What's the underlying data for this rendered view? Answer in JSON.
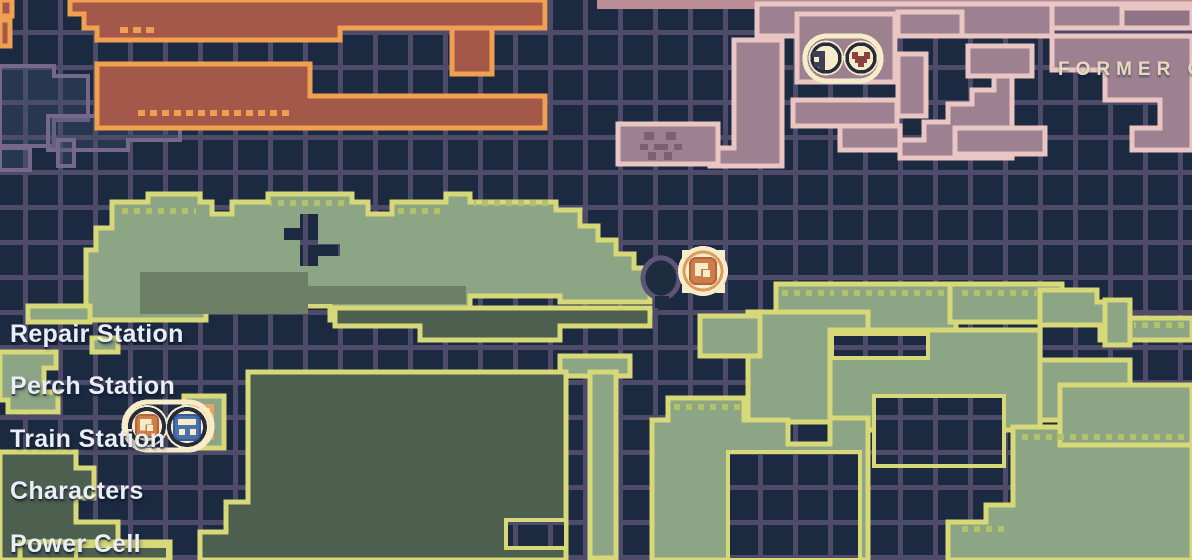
{
  "map": {
    "area_label": "FORMER CO",
    "legend": {
      "items": [
        "Repair Station",
        "Perch Station",
        "Train Station",
        "Characters",
        "Power Cell"
      ]
    },
    "markers": [
      {
        "name": "repair-perch-pair",
        "icons": [
          "wrench-icon",
          "heart-icon"
        ]
      },
      {
        "name": "character-marker",
        "icons": [
          "character-icon"
        ]
      },
      {
        "name": "train-station-pair",
        "icons": [
          "character-icon",
          "train-icon"
        ]
      }
    ],
    "palette": {
      "background": "#1b2941",
      "grid_line": "#4e4a69",
      "room_red_fill": "#a3584a",
      "room_red_outline": "#f0a050",
      "room_pink_fill": "#9d8190",
      "room_pink_outline": "#e9c6c4",
      "room_green_fill": "#8ca585",
      "room_green_outline": "#d7d877",
      "room_green_dark": "#4d5f4e",
      "room_green_shadow": "#6d8066",
      "unexplored_outline": "#75688a",
      "badge_cream": "#f6ecca",
      "badge_ring": "#272c3c",
      "icon_orange": "#cd7d4a",
      "icon_blue": "#4a70ae",
      "icon_heart": "#8c4040",
      "icon_wrench": "#3d3f55",
      "legend_text": "#e9eef5",
      "area_text": "#e5dbc1"
    }
  }
}
